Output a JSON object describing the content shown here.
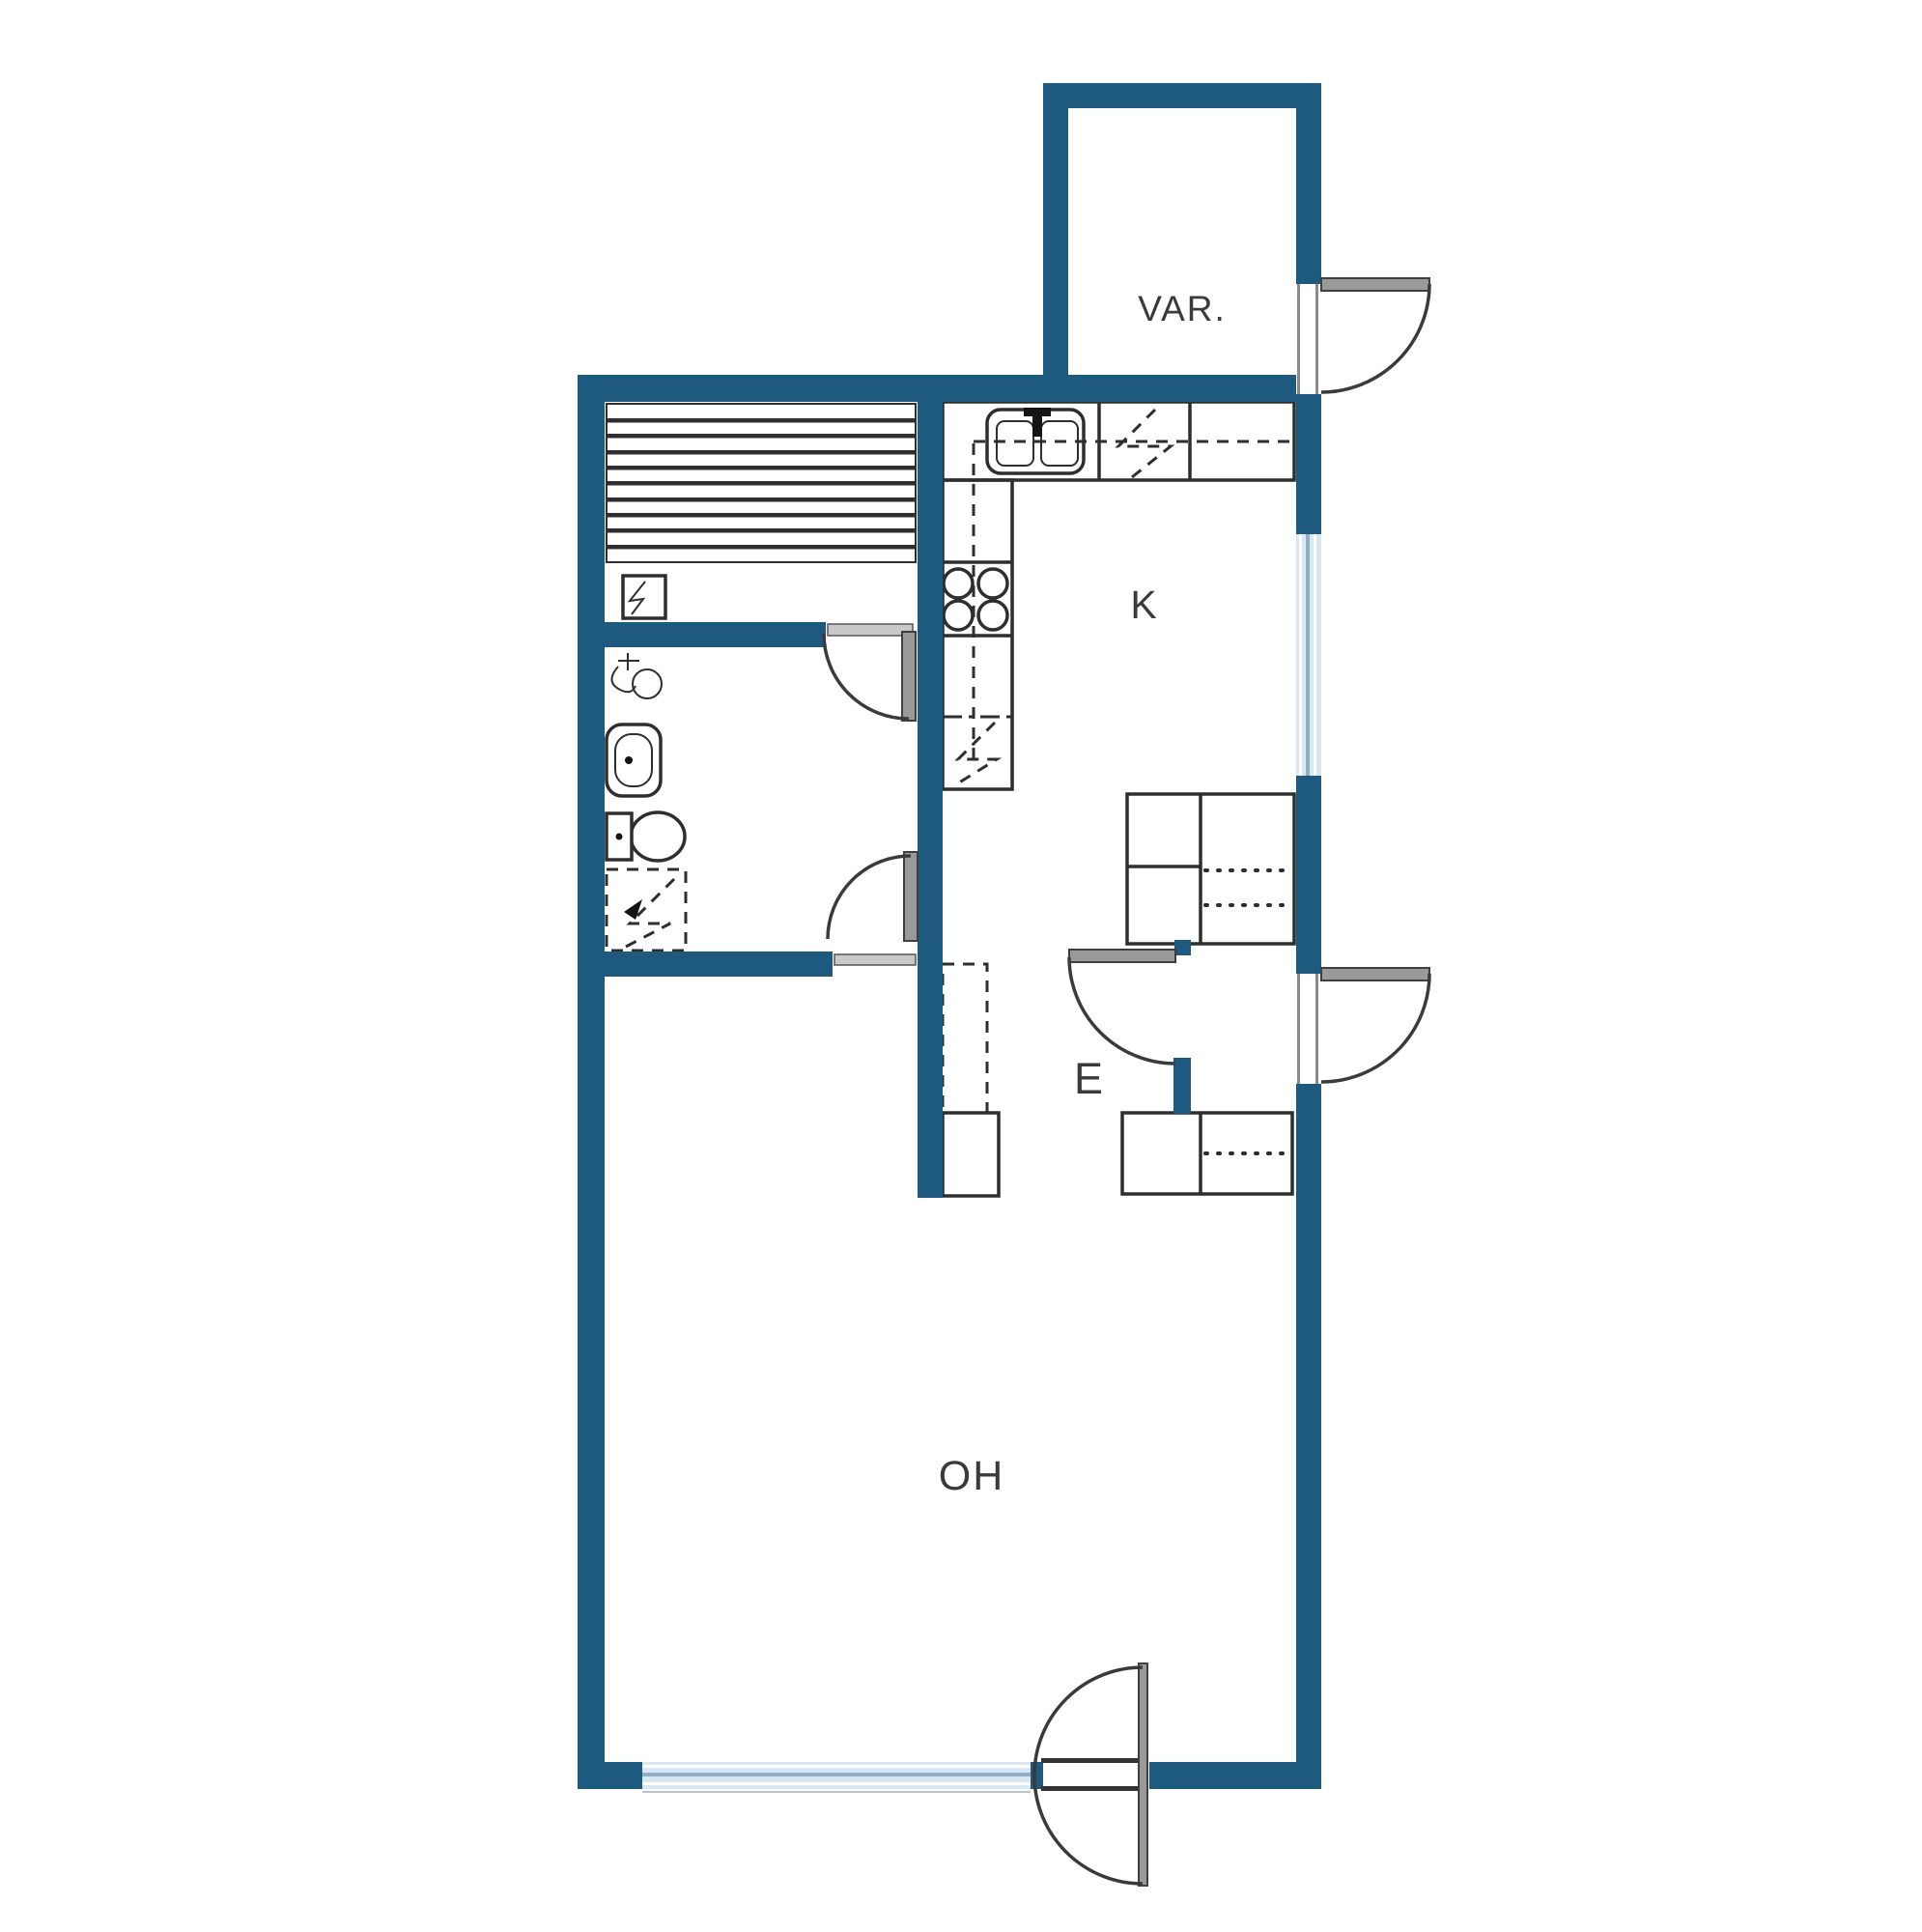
{
  "page": {
    "type": "architectural-floor-plan",
    "background": "#ffffff"
  },
  "rooms": [
    {
      "id": "var",
      "label": "VAR."
    },
    {
      "id": "k",
      "label": "K"
    },
    {
      "id": "e",
      "label": "E"
    },
    {
      "id": "oh",
      "label": "OH"
    }
  ],
  "colors": {
    "wall": "#1e5a80",
    "line": "#2e2e2e",
    "door_leaf": "#9a9a9a",
    "window_glass": "#d8e7f1",
    "window_line": "#8fb0c4",
    "label": "#3a3a3a",
    "floor": "#ffffff"
  },
  "fixtures": [
    "sauna-benches",
    "sauna-heater",
    "sauna-door",
    "shower-mixer",
    "washbasin",
    "toilet",
    "washing-machine-reservation",
    "bathroom-door",
    "kitchen-sink",
    "stove-cooktop",
    "fridge-reservation",
    "dishwasher-reservation",
    "kitchen-counter",
    "upper-cabinet-dashed-line",
    "wardrobe-closet-upper",
    "wardrobe-closet-lower",
    "closet-reservation",
    "hall-cabinet",
    "hall-door",
    "entrance-door",
    "storage-door",
    "bottom-double-door",
    "kitchen-window",
    "living-room-window"
  ]
}
